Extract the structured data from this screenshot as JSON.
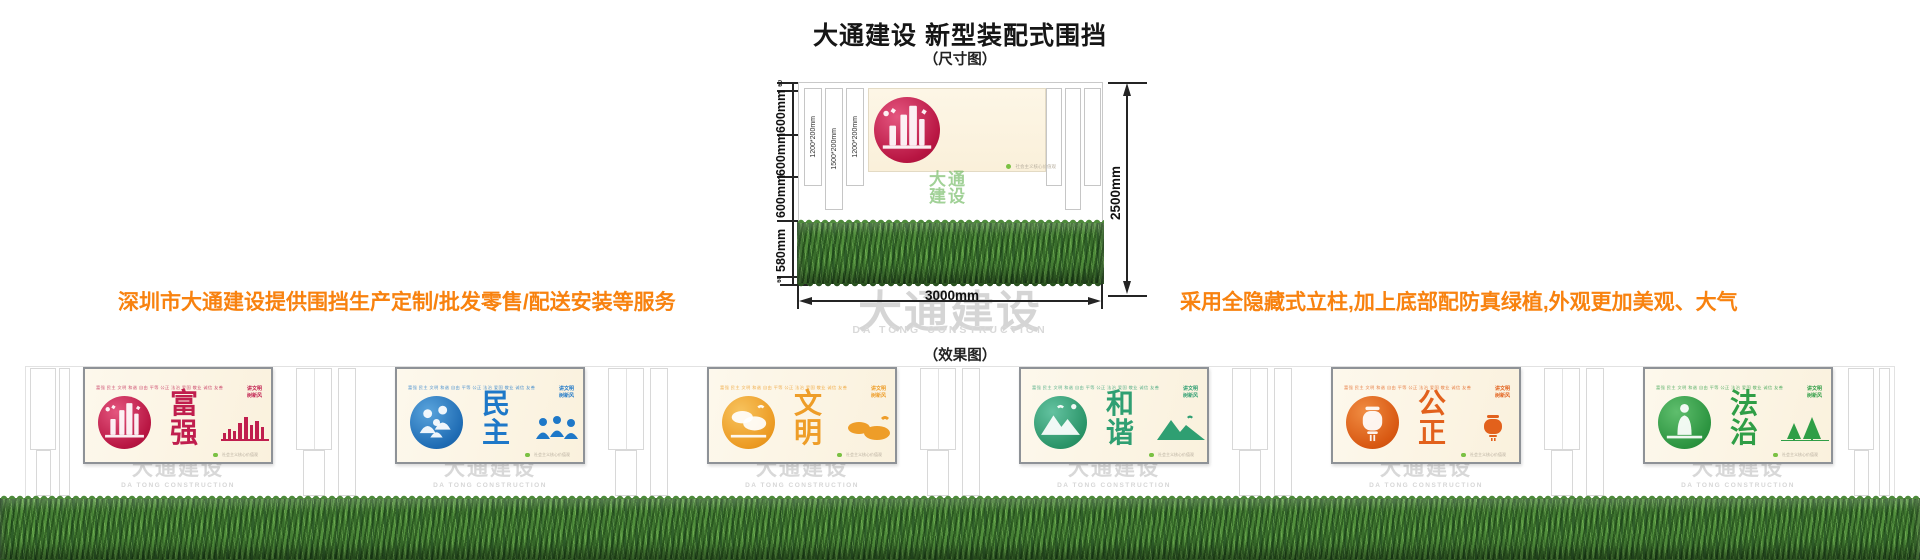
{
  "header": {
    "title": "大通建设 新型装配式围挡",
    "size_caption": "（尺寸图）",
    "effect_caption": "（效果图）"
  },
  "notes": {
    "left": "深圳市大通建设提供围挡生产定制/批发零售/配送安装等服务",
    "right": "采用全隐藏式立柱,加上底部配防真绿植,外观更加美观、大气",
    "color": "#f8820f"
  },
  "dimensions": {
    "left_segments": [
      "60",
      "600mm",
      "600mm",
      "600mm",
      "580mm",
      "60"
    ],
    "total_height": "2500mm",
    "total_width": "3000mm",
    "post_sizes": [
      "1200*200mm",
      "1500*200mm",
      "1200*200mm"
    ]
  },
  "display_panel": {
    "header_note": "培育和践行社会主义核心价值观",
    "slogan_line1": "讲文明",
    "slogan_line2": "树新风",
    "value_rows": [
      "富强 民主 文明 和谐",
      "自由 平等 公正 法治",
      "爱国 敬业 诚信 友善"
    ],
    "badge_note": "社会主义核心价值观",
    "accent_color": "#de5078"
  },
  "watermarks": {
    "logo_line1": "大通",
    "logo_line2": "建设",
    "brand_name": "大通建设",
    "brand_sub": "DA TONG CONSTRUCTION"
  },
  "effect": {
    "values_row": "富强 民主 文明 和谐 自由 平等 公正 法治 爱国 敬业 诚信 友善",
    "slogan_line1": "讲文明",
    "slogan_line2": "树新风",
    "badge_note": "社会主义核心价值观",
    "panels": [
      {
        "char1": "富",
        "char2": "强",
        "color": "#c01e4e"
      },
      {
        "char1": "民",
        "char2": "主",
        "color": "#1e78c8"
      },
      {
        "char1": "文",
        "char2": "明",
        "color": "#ee9d28"
      },
      {
        "char1": "和",
        "char2": "谐",
        "color": "#2f9f72"
      },
      {
        "char1": "公",
        "char2": "正",
        "color": "#e2611c"
      },
      {
        "char1": "法",
        "char2": "治",
        "color": "#2f9e46"
      }
    ]
  }
}
